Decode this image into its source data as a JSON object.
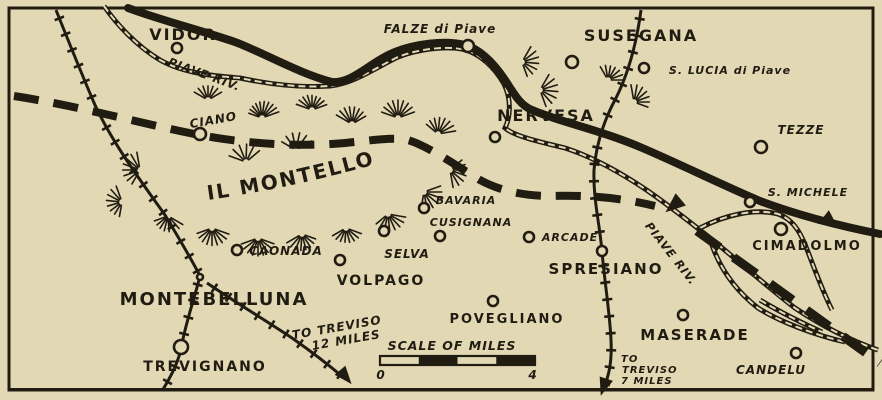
{
  "map": {
    "colors": {
      "paper": "#e2d8b4",
      "ink": "#211c12"
    },
    "towns": [
      {
        "name": "vidor",
        "label": "VIDOR",
        "cx": 177,
        "cy": 48,
        "r": 5,
        "lx": 183,
        "ly": 40,
        "size": 16,
        "style": "caps"
      },
      {
        "name": "falze-di-piave",
        "label": "FALZE di Piave",
        "cx": 468,
        "cy": 46,
        "r": 6,
        "lx": 440,
        "ly": 33,
        "size": 12,
        "style": "ital"
      },
      {
        "name": "susegana",
        "label": "SUSEGANA",
        "cx": 572,
        "cy": 62,
        "r": 6,
        "lx": 641,
        "ly": 41,
        "size": 16,
        "style": "caps"
      },
      {
        "name": "s-lucia-di-piave",
        "label": "S. LUCIA di Piave",
        "cx": 644,
        "cy": 68,
        "r": 5,
        "lx": 730,
        "ly": 74,
        "size": 11,
        "style": "ital"
      },
      {
        "name": "tezze",
        "label": "TEZZE",
        "cx": 761,
        "cy": 147,
        "r": 6,
        "lx": 801,
        "ly": 134,
        "size": 12,
        "style": "ital"
      },
      {
        "name": "ciano",
        "label": "CIANO",
        "cx": 200,
        "cy": 134,
        "r": 6,
        "lx": 214,
        "ly": 124,
        "size": 12,
        "style": "ital",
        "rot": -10
      },
      {
        "name": "nervesa",
        "label": "NERVESA",
        "cx": 495,
        "cy": 137,
        "r": 5,
        "lx": 546,
        "ly": 121,
        "size": 16,
        "style": "caps"
      },
      {
        "name": "s-michele",
        "label": "S. MICHELE",
        "cx": 750,
        "cy": 202,
        "r": 5,
        "lx": 808,
        "ly": 196,
        "size": 11,
        "style": "ital"
      },
      {
        "name": "cimadolmo",
        "label": "CIMADOLMO",
        "cx": 781,
        "cy": 229,
        "r": 6,
        "lx": 807,
        "ly": 250,
        "size": 13,
        "style": "caps"
      },
      {
        "name": "bavaria",
        "label": "BAVARIA",
        "cx": 424,
        "cy": 208,
        "r": 5,
        "lx": 466,
        "ly": 204,
        "size": 11,
        "style": "ital"
      },
      {
        "name": "cusignana",
        "label": "CUSIGNANA",
        "cx": 440,
        "cy": 236,
        "r": 5,
        "lx": 471,
        "ly": 226,
        "size": 11,
        "style": "ital"
      },
      {
        "name": "selva",
        "label": "SELVA",
        "cx": 384,
        "cy": 231,
        "r": 5,
        "lx": 407,
        "ly": 258,
        "size": 12,
        "style": "ital"
      },
      {
        "name": "arcade",
        "label": "ARCADE",
        "cx": 529,
        "cy": 237,
        "r": 5,
        "lx": 570,
        "ly": 241,
        "size": 11,
        "style": "ital"
      },
      {
        "name": "caonada",
        "label": "CAONADA",
        "cx": 237,
        "cy": 250,
        "r": 5,
        "lx": 286,
        "ly": 255,
        "size": 12,
        "style": "ital"
      },
      {
        "name": "spresiano",
        "label": "SPRESIANO",
        "cx": 602,
        "cy": 251,
        "r": 5,
        "lx": 606,
        "ly": 274,
        "size": 15,
        "style": "caps"
      },
      {
        "name": "volpago",
        "label": "VOLPAGO",
        "cx": 340,
        "cy": 260,
        "r": 5,
        "lx": 381,
        "ly": 285,
        "size": 14,
        "style": "caps"
      },
      {
        "name": "montebelluna",
        "label": "MONTEBELLUNA",
        "cx": 200,
        "cy": 277,
        "r": 3,
        "lx": 214,
        "ly": 305,
        "size": 18,
        "style": "caps"
      },
      {
        "name": "povegliano",
        "label": "POVEGLIANO",
        "cx": 493,
        "cy": 301,
        "r": 5,
        "lx": 507,
        "ly": 323,
        "size": 13,
        "style": "caps"
      },
      {
        "name": "maserade",
        "label": "MASERADE",
        "cx": 683,
        "cy": 315,
        "r": 5,
        "lx": 695,
        "ly": 340,
        "size": 15,
        "style": "caps"
      },
      {
        "name": "trevignano",
        "label": "TREVIGNANO",
        "cx": 181,
        "cy": 347,
        "r": 7,
        "lx": 205,
        "ly": 371,
        "size": 14,
        "style": "caps"
      },
      {
        "name": "candelu",
        "label": "CANDELU",
        "cx": 796,
        "cy": 353,
        "r": 5,
        "lx": 771,
        "ly": 374,
        "size": 12,
        "style": "ital"
      }
    ],
    "labels": {
      "river_upper": "PIAVE RIV.",
      "river_lower": "PIAVE RIV.",
      "montello": "IL MONTELLO",
      "scale_title": "SCALE OF MILES",
      "scale_start": "0",
      "scale_end": "4",
      "to_treviso_sw_line1": "TO TREVISO",
      "to_treviso_sw_line2": "12 MILES",
      "to_treviso_s_line1": "TO",
      "to_treviso_s_line2": "TREVISO",
      "to_treviso_s_line3": "7 MILES"
    }
  }
}
